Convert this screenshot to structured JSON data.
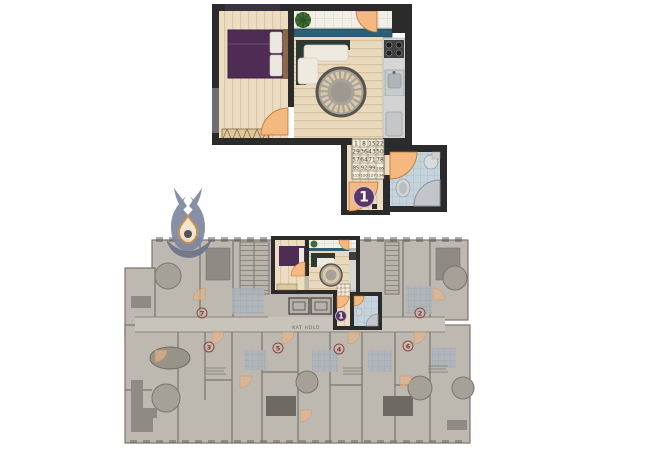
{
  "page": {
    "background": "#ffffff"
  },
  "detail_plan": {
    "unit_number": "1",
    "scale_grid": {
      "rows": [
        [
          "1",
          "8",
          "15",
          "22"
        ],
        [
          "29",
          "36",
          "43",
          "50"
        ],
        [
          "57",
          "64",
          "71",
          "78"
        ],
        [
          "85",
          "92",
          "99",
          "106"
        ],
        [
          "113",
          "120",
          "127",
          "134"
        ]
      ]
    }
  },
  "floor_plan": {
    "corridor_label": "KAT HOLÜ",
    "highlighted_unit_number": "1",
    "unit_badges": [
      {
        "number": "7"
      },
      {
        "number": "2"
      },
      {
        "number": "3"
      },
      {
        "number": "5"
      },
      {
        "number": "4"
      },
      {
        "number": "6"
      }
    ]
  },
  "watermark": {
    "icon": "tulip-drop-logo"
  },
  "colors": {
    "wall": "#2b2b2b",
    "wood_floor": "#ecdcc2",
    "door_accent": "#f5b87f",
    "bed_purple": "#4e2c54",
    "window_teal": "#2e6075",
    "bath_tile_blue": "#c5d3dd",
    "unit_badge_red": "#7a3a32",
    "unit_circle_purple": "#5a3766",
    "floorplan_gray": "#bdb9b1",
    "logo_blue_gray": "#7d87a0"
  }
}
